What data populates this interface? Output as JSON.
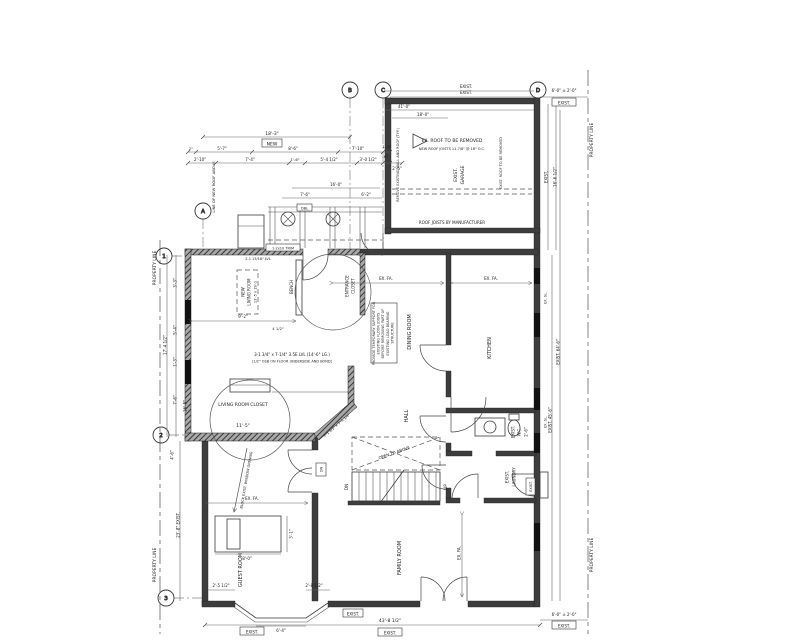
{
  "colors": {
    "ink": "#1a1a1a",
    "wall": "#3d3d3d",
    "dim": "#666666",
    "background": "#ffffff"
  },
  "grid": {
    "a": "A",
    "b": "B",
    "c": "C",
    "d": "D",
    "n1": "1",
    "n2": "2",
    "n3": "3"
  },
  "site": {
    "property_line": "PROPERTY LINE"
  },
  "rooms": {
    "living_room": {
      "l1": "NEW",
      "l2": "LIVING ROOM",
      "l3": "13'-5 x 19'-1"
    },
    "entrance_closet": {
      "l1": "ENTRANCE",
      "l2": "CLOSET"
    },
    "hall": "HALL",
    "dining_room": "DINING ROOM",
    "kitchen": "KITCHEN",
    "living_room_closet": "LIVING ROOM CLOSET",
    "guest_room": "GUEST ROOM",
    "family_room": "FAMILY ROOM",
    "wc": {
      "l1": "EXIST.",
      "l2": "W.C.",
      "dim": "2'-6\""
    },
    "laundry": {
      "l1": "EXIST.",
      "l2": "LAUNDRY"
    },
    "garage": {
      "l1": "EXIST.",
      "l2": "GARAGE"
    },
    "open_to_above": "OPEN TO ABOVE"
  },
  "tags": {
    "exist": "EXIST.",
    "new": "NEW",
    "dn": "DN",
    "up": "UP",
    "dbl": "DBL",
    "ex_fa": "EX. FA.",
    "ex_sl": "EX. SL."
  },
  "notes": {
    "support": {
      "l1": "PROVIDE TEMPORARY SUPPORT FOR",
      "l2": "EXISTING FLOOR JOISTS",
      "l3": "BEFORE REMOVING PART OF",
      "l4": "EXISTING LOAD BEARING",
      "l5": "STRUCTURE"
    },
    "roof_removed": "EX. ROOF TO BE REMOVED",
    "new_roof_joists": "NEW ROOF JOISTS 11-7/8\" @ 16\" O.C.",
    "roof_joists_mfr": "ROOF JOISTS BY MANUFACTURER",
    "remove_wall": "REMOVE EXISTING WALL AND ROOF (TYP.)",
    "exist_roof_removed": "EXIST. ROOF TO BE REMOVED",
    "line_of_roof": "LINE OF NEW ROOF ABOVE",
    "lvl1": "3-1 3/4\" x 7-1/4\" 3.5E LVL (14'-6\" LG.)",
    "lvl2": "(1/2\" OSB ON FLOOR UNDERSIDE AND BOND)",
    "lvl_header": "2-1 13/16\" LVL",
    "trim": "1-2x10 TRIM",
    "block_window": "BLOCK EXIST. WINDOW OPENING",
    "diag_size": "3'-1 1/2\" x 7'-1 1/4\""
  },
  "dims": {
    "top1": "18'-3\"",
    "t2a": "2\"",
    "t2b": "5'-7\"",
    "t2c": "8'-6\"",
    "t2d": "7'-10\"",
    "t2e": "1'-6\"",
    "t3a": "2'-10\"",
    "t3b": "7'-4\"",
    "t3c": "1'-6\"",
    "t3d": "5'-4 1/2\"",
    "t3e": "3'-0 1/2\"",
    "t3f": "-6\"",
    "t3g": "2'-6\"",
    "g1": "41'-0\"",
    "g2": "18'-0\"",
    "f1": "16'-0\"",
    "f2": "7'-6\"",
    "f3": "6'-2\"",
    "lr1": "9'-2\"",
    "lr2": "4 1/2\"",
    "cl1": "11'-5\"",
    "lv1": "3'-3\"",
    "lv2": "5'-4\"",
    "lv3": "1'-3\"",
    "lv4": "17'-4 1/2\"",
    "lv5": "16'-5\"",
    "lv6": "4'-6\"",
    "lv7": "23'-8\" EXIST.",
    "gr1": "8'-0\"",
    "gr2": "3'-1\"",
    "b1": "2'-5 1/2\"",
    "b2": "2'-8 1/2\"",
    "b3": "6'-4\"",
    "b4": "43'-8 1/2\"",
    "r1": "6'-0\" ± 2'-0\"",
    "r2": "16'-6 1/2\"",
    "r3": "EXIST. 64'-6\"",
    "r4": "EXIST. 45'-6\""
  }
}
